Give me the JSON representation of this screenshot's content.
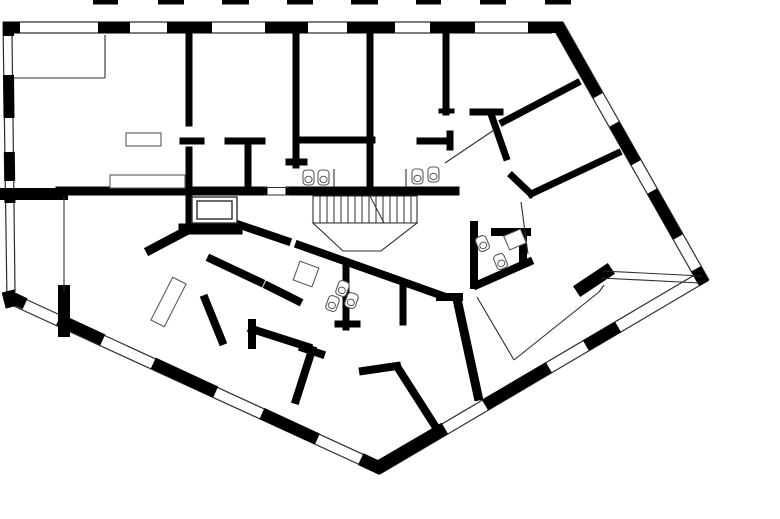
{
  "title": "apartment-floor-plan",
  "canvas": {
    "w": 780,
    "h": 519
  },
  "colors": {
    "bg": "#ffffff",
    "wall": "#000000",
    "thin": "#2e2e2e",
    "fixture": "#5a5a5a"
  },
  "floor_plan": {
    "upper_floor_dashes": {
      "y": 0,
      "h": 4.5,
      "spans": [
        [
          93,
          118
        ],
        [
          158,
          184
        ],
        [
          222,
          249
        ],
        [
          287,
          313
        ],
        [
          351,
          378
        ],
        [
          416,
          441
        ],
        [
          480,
          506
        ],
        [
          545,
          571
        ]
      ]
    },
    "facade_edges": [
      {
        "name": "top-facade",
        "outer": [
          3,
          22,
          563,
          22
        ],
        "inner": [
          3,
          33,
          552,
          33
        ]
      },
      {
        "name": "left-facade",
        "outer": [
          3,
          22,
          7,
          302
        ],
        "inner": [
          12,
          33,
          15,
          292
        ]
      },
      {
        "name": "right-upper-facade",
        "outer": [
          563,
          22,
          709,
          280
        ],
        "inner": [
          553,
          28,
          699,
          285
        ]
      },
      {
        "name": "right-lower-facade",
        "outer": [
          709,
          280,
          380,
          474
        ],
        "inner": [
          703,
          270,
          374,
          464
        ]
      },
      {
        "name": "left-lower-facade",
        "outer": [
          5,
          302,
          380,
          474
        ],
        "inner": [
          10,
          292,
          384,
          464
        ]
      }
    ],
    "facade_piers": [
      {
        "seg": [
          3,
          27.5,
          20,
          27.5
        ],
        "w": 11
      },
      {
        "seg": [
          98,
          27.5,
          130,
          27.5
        ],
        "w": 11
      },
      {
        "seg": [
          167,
          27.5,
          212,
          27.5
        ],
        "w": 11
      },
      {
        "seg": [
          265,
          27.5,
          308,
          27.5
        ],
        "w": 11
      },
      {
        "seg": [
          347,
          27.5,
          395,
          27.5
        ],
        "w": 11
      },
      {
        "seg": [
          430,
          27.5,
          475,
          27.5
        ],
        "w": 11
      },
      {
        "seg": [
          528,
          27.5,
          563,
          27.5
        ],
        "w": 11
      },
      {
        "seg": [
          8.5,
          22,
          8.5,
          36
        ],
        "w": 11
      },
      {
        "seg": [
          8.5,
          75,
          9,
          118
        ],
        "w": 11
      },
      {
        "seg": [
          9.3,
          152,
          9.7,
          181
        ],
        "w": 11
      },
      {
        "seg": [
          9.8,
          193,
          10,
          203
        ],
        "w": 11
      },
      {
        "seg": [
          8,
          291,
          12,
          307
        ],
        "w": 13
      },
      {
        "seg": [
          558,
          25,
          598,
          95.7
        ],
        "w": 11
      },
      {
        "seg": [
          614.1,
          124.1,
          636,
          162.8
        ],
        "w": 11
      },
      {
        "seg": [
          652,
          191.2,
          678,
          237.1
        ],
        "w": 11
      },
      {
        "seg": [
          696,
          268.8,
          704,
          283
        ],
        "w": 11
      },
      {
        "seg": [
          705,
          276,
          698.4,
          279.8
        ],
        "w": 12
      },
      {
        "seg": [
          618.1,
          326.9,
          585.9,
          345.7
        ],
        "w": 12
      },
      {
        "seg": [
          548.9,
          367.4,
          484.9,
          404.9
        ],
        "w": 12
      },
      {
        "seg": [
          444.8,
          428.3,
          377,
          468
        ],
        "w": 13
      },
      {
        "seg": [
          8.3,
          296,
          25.1,
          303.8
        ],
        "w": 12
      },
      {
        "seg": [
          58.7,
          319.4,
          102.8,
          339.8
        ],
        "w": 12
      },
      {
        "seg": [
          153.3,
          363.1,
          215.7,
          392
        ],
        "w": 12
      },
      {
        "seg": [
          262,
          413.5,
          317.4,
          439.1
        ],
        "w": 12
      },
      {
        "seg": [
          360.7,
          459.1,
          382,
          469
        ],
        "w": 13
      }
    ],
    "interior_walls": [
      {
        "name": "living-wall-a",
        "seg": [
          5,
          194,
          62,
          194
        ],
        "w": 12
      },
      {
        "name": "living-wall-b",
        "seg": [
          60,
          191,
          263,
          191
        ],
        "w": 9
      },
      {
        "name": "corridor-wall",
        "seg": [
          290,
          191,
          455,
          191
        ],
        "w": 9
      },
      {
        "name": "room1-wall-upper",
        "seg": [
          189,
          33,
          189,
          123
        ],
        "w": 7
      },
      {
        "name": "room1-wall-lower",
        "seg": [
          189,
          150,
          189,
          196
        ],
        "w": 7
      },
      {
        "name": "room2-partition-a",
        "seg": [
          183,
          141,
          201,
          141
        ],
        "w": 7
      },
      {
        "name": "room2-partition-b",
        "seg": [
          228,
          141,
          262,
          141
        ],
        "w": 7
      },
      {
        "name": "room2-closet-wall",
        "seg": [
          248,
          141,
          248,
          187
        ],
        "w": 7
      },
      {
        "name": "room3-wall",
        "seg": [
          296,
          33,
          296,
          165
        ],
        "w": 7
      },
      {
        "name": "room3-wall-cap",
        "seg": [
          289,
          162,
          304,
          162
        ],
        "w": 7
      },
      {
        "name": "room3-partition",
        "seg": [
          296,
          140,
          372,
          140
        ],
        "w": 7
      },
      {
        "name": "bath-wall",
        "seg": [
          370,
          33,
          370,
          191
        ],
        "w": 7
      },
      {
        "name": "room4-wall",
        "seg": [
          446,
          33,
          446,
          112
        ],
        "w": 7
      },
      {
        "name": "room4-wall-foot",
        "seg": [
          441,
          111,
          452,
          111
        ],
        "w": 5
      },
      {
        "name": "hall-wall",
        "seg": [
          420,
          141,
          450,
          141
        ],
        "w": 7
      },
      {
        "name": "hall-wall-cap",
        "seg": [
          450,
          134,
          450,
          147
        ],
        "w": 7
      },
      {
        "name": "entry-wall-top",
        "seg": [
          473,
          112,
          500,
          112
        ],
        "w": 7
      },
      {
        "name": "entry-wall-drop",
        "seg": [
          491,
          114,
          506,
          157
        ],
        "w": 7
      },
      {
        "name": "diag-wall-1",
        "seg": [
          577,
          83,
          503,
          122
        ],
        "w": 7
      },
      {
        "name": "diag-wall-2",
        "seg": [
          618,
          153,
          531,
          194
        ],
        "w": 7
      },
      {
        "name": "diag-wall-2-stub",
        "seg": [
          512,
          176,
          531,
          194
        ],
        "w": 7
      },
      {
        "name": "bath2-wall-left",
        "seg": [
          474,
          225,
          474,
          285
        ],
        "w": 8
      },
      {
        "name": "bath2-wall-top",
        "seg": [
          495,
          232,
          527,
          232
        ],
        "w": 8
      },
      {
        "name": "bath2-wall-right",
        "seg": [
          523,
          232,
          523,
          263
        ],
        "w": 8
      },
      {
        "name": "bath2-wall-bottom",
        "seg": [
          477,
          285,
          529,
          262
        ],
        "w": 8
      },
      {
        "name": "spine-wall-a",
        "seg": [
          237,
          224,
          287,
          241
        ],
        "w": 8
      },
      {
        "name": "spine-wall-b",
        "seg": [
          299,
          245,
          443,
          296
        ],
        "w": 8
      },
      {
        "name": "room5-wall-cap",
        "seg": [
          440,
          297,
          459,
          297
        ],
        "w": 8
      },
      {
        "name": "room5-wall",
        "seg": [
          457,
          299,
          478,
          396
        ],
        "w": 9
      },
      {
        "name": "elevator-wall-left",
        "seg": [
          189,
          196,
          189,
          229
        ],
        "w": 7
      },
      {
        "name": "elevator-wall-bottom",
        "seg": [
          184,
          229,
          237,
          229
        ],
        "w": 11
      },
      {
        "name": "elevator-diag-wall",
        "seg": [
          186,
          231,
          150,
          250
        ],
        "w": 9
      },
      {
        "name": "spine2-wall-a",
        "seg": [
          211,
          259,
          260,
          282
        ],
        "w": 8
      },
      {
        "name": "spine2-wall-b",
        "seg": [
          268,
          286,
          298,
          301
        ],
        "w": 8
      },
      {
        "name": "room6-partition",
        "seg": [
          205,
          299,
          222,
          341
        ],
        "w": 8
      },
      {
        "name": "room7-wall",
        "seg": [
          252,
          329,
          308,
          347
        ],
        "w": 8
      },
      {
        "name": "room7-wall-cap",
        "seg": [
          252,
          323,
          252,
          345
        ],
        "w": 8
      },
      {
        "name": "room7-partition",
        "seg": [
          312,
          350,
          296,
          400
        ],
        "w": 8
      },
      {
        "name": "room7-partition-cap",
        "seg": [
          303,
          348,
          321,
          354
        ],
        "w": 8
      },
      {
        "name": "bath3-wall",
        "seg": [
          346,
          264,
          346,
          327
        ],
        "w": 7
      },
      {
        "name": "bath3-wall-cap",
        "seg": [
          338,
          324,
          357,
          324
        ],
        "w": 7
      },
      {
        "name": "bath3-wall-right",
        "seg": [
          403,
          284,
          403,
          322
        ],
        "w": 7
      },
      {
        "name": "room8-partition",
        "seg": [
          437,
          429,
          398,
          368
        ],
        "w": 8
      },
      {
        "name": "room8-partition-cap",
        "seg": [
          363,
          371,
          397,
          366
        ],
        "w": 8
      },
      {
        "name": "loggia-wall",
        "seg": [
          64,
          291,
          64,
          331
        ],
        "w": 12
      },
      {
        "name": "terrace-wall",
        "seg": [
          582,
          288,
          606,
          272
        ],
        "w": 13
      }
    ],
    "thin_lines": [
      {
        "name": "closet-line",
        "seg": [
          14,
          78,
          105,
          78
        ]
      },
      {
        "name": "closet-line-v",
        "seg": [
          105,
          35,
          105,
          78
        ]
      },
      {
        "name": "balcony-glass-line",
        "seg": [
          64,
          196,
          64,
          292
        ]
      },
      {
        "name": "door-sill-top",
        "seg": [
          264,
          187.5,
          289,
          187.5
        ]
      },
      {
        "name": "door-sill-bottom",
        "seg": [
          264,
          195,
          289,
          195
        ]
      },
      {
        "name": "terrace-rail-outer",
        "seg": [
          603,
          271,
          702,
          276
        ]
      },
      {
        "name": "terrace-rail-inner",
        "seg": [
          601,
          278,
          700,
          283
        ]
      },
      {
        "name": "terrace-line-a",
        "seg": [
          477,
          297,
          514,
          360
        ]
      },
      {
        "name": "terrace-line-b",
        "seg": [
          514,
          360,
          599,
          292
        ]
      },
      {
        "name": "terrace-line-c",
        "seg": [
          599,
          292,
          604,
          285
        ]
      },
      {
        "name": "wardrobe-line",
        "seg": [
          445,
          163,
          494,
          130
        ]
      },
      {
        "name": "hall2-line",
        "seg": [
          521,
          202,
          528,
          254
        ]
      },
      {
        "name": "wc-partition-left",
        "seg": [
          334,
          169,
          334,
          187
        ]
      },
      {
        "name": "wc-partition-right",
        "seg": [
          406,
          169,
          406,
          187
        ]
      },
      {
        "name": "counter-divider",
        "seg": [
          124,
          175,
          124,
          188
        ]
      }
    ],
    "thin_rects": [
      {
        "name": "table",
        "x": 126,
        "y": 133,
        "w": 35,
        "h": 13,
        "rot": 0
      },
      {
        "name": "counter",
        "x": 110,
        "y": 175,
        "w": 75,
        "h": 13,
        "rot": 0
      },
      {
        "name": "sideboard",
        "x": 161,
        "y": 278,
        "w": 15,
        "h": 48,
        "rot": 27
      },
      {
        "name": "shower-1",
        "x": 296,
        "y": 264,
        "w": 20,
        "h": 20,
        "rot": 20
      },
      {
        "name": "shower-2",
        "x": 506,
        "y": 232,
        "w": 18,
        "h": 15,
        "rot": -23
      }
    ],
    "fixtures": [
      {
        "name": "wc",
        "x": 303,
        "y": 170,
        "rot": 0
      },
      {
        "name": "wc",
        "x": 318,
        "y": 170,
        "rot": 0
      },
      {
        "name": "wc",
        "x": 412,
        "y": 169,
        "rot": 0
      },
      {
        "name": "wc",
        "x": 428,
        "y": 167,
        "rot": 0
      },
      {
        "name": "wc",
        "x": 477,
        "y": 236,
        "rot": -23
      },
      {
        "name": "sink",
        "x": 495,
        "y": 254,
        "rot": -23
      },
      {
        "name": "wc",
        "x": 327,
        "y": 296,
        "rot": 20
      },
      {
        "name": "sink",
        "x": 337,
        "y": 281,
        "rot": 20
      },
      {
        "name": "sink",
        "x": 346,
        "y": 293,
        "rot": 20
      }
    ],
    "stairs": {
      "x1": 313,
      "y1": 196,
      "x2": 417,
      "y2": 223,
      "tread_step": 7,
      "diagonal": [
        370,
        196,
        384,
        223
      ],
      "landing": "313,223 417,223 381,251 343,251"
    },
    "elevator": {
      "outer": {
        "x": 192,
        "y": 197,
        "w": 45,
        "h": 26
      },
      "inner": {
        "x": 197,
        "y": 201,
        "w": 35,
        "h": 18
      }
    }
  }
}
